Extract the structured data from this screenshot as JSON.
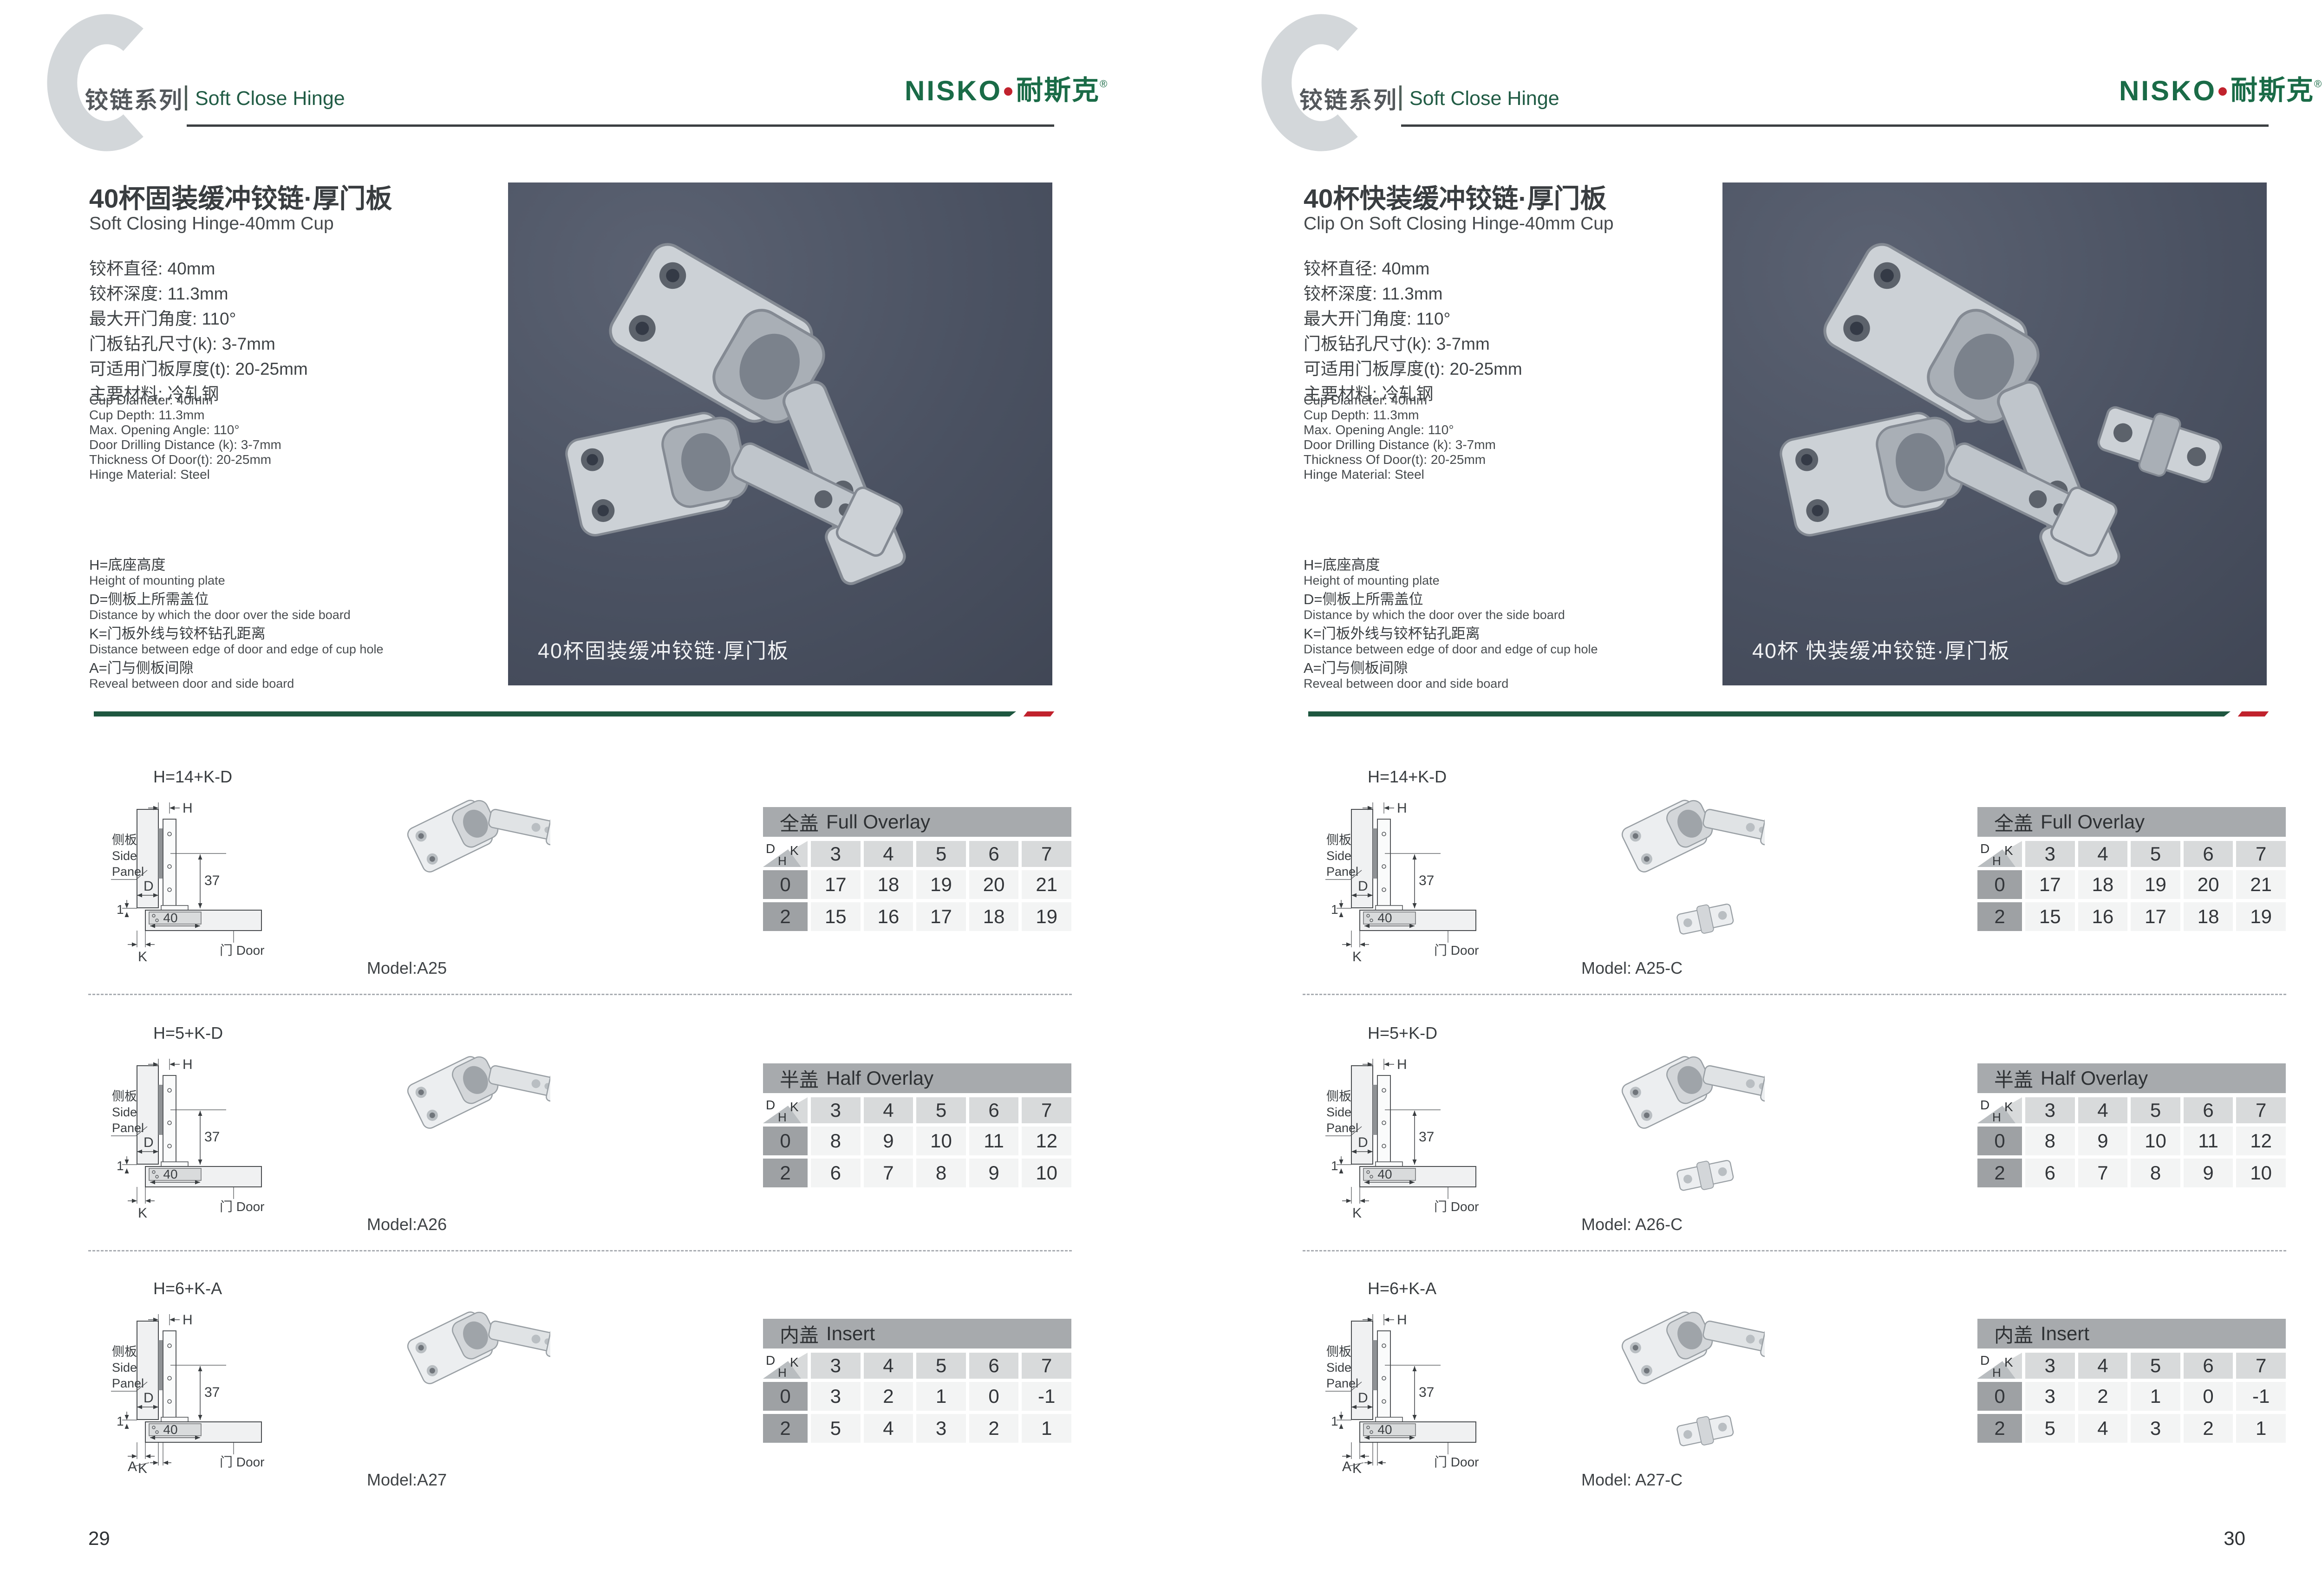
{
  "brand": {
    "latin": "NISKO",
    "cn": "耐斯克",
    "reg": "®"
  },
  "header": {
    "series_cn": "铰链系列",
    "series_en": "Soft Close Hinge",
    "watermark_letter": "C"
  },
  "specs_cn": [
    "铰杯直径: 40mm",
    "铰杯深度: 11.3mm",
    "最大开门角度: 110°",
    "门板钻孔尺寸(k): 3-7mm",
    "可适用门板厚度(t): 20-25mm",
    "主要材料: 冷轧钢"
  ],
  "specs_en": [
    "Cup Diameter: 40mm",
    "Cup Depth: 11.3mm",
    "Max. Opening Angle: 110°",
    "Door Drilling Distance (k): 3-7mm",
    "Thickness Of Door(t): 20-25mm",
    "Hinge Material: Steel"
  ],
  "legend": [
    {
      "cn": "H=底座高度",
      "en": "Height of mounting plate"
    },
    {
      "cn": "D=侧板上所需盖位",
      "en": "Distance by which the door over the side board"
    },
    {
      "cn": "K=门板外线与铰杯钻孔距离",
      "en": "Distance between edge of door and edge of cup hole"
    },
    {
      "cn": "A=门与侧板间隙",
      "en": "Reveal between door and side board"
    }
  ],
  "diagram_labels": {
    "h": "H",
    "d": "D",
    "k": "K",
    "a": "A",
    "one": "1",
    "forty": "40",
    "thirtyseven": "37",
    "side_cn": "侧板",
    "side_en1": "Side",
    "side_en2": "Panel",
    "door": "门 Door"
  },
  "tables": [
    {
      "title_cn": "全盖",
      "title_en": "Full Overlay",
      "corner": {
        "d": "D",
        "k": "K",
        "h": "H"
      },
      "k_values": [
        "3",
        "4",
        "5",
        "6",
        "7"
      ],
      "rows": [
        {
          "h": "0",
          "values": [
            "17",
            "18",
            "19",
            "20",
            "21"
          ]
        },
        {
          "h": "2",
          "values": [
            "15",
            "16",
            "17",
            "18",
            "19"
          ]
        }
      ]
    },
    {
      "title_cn": "半盖",
      "title_en": "Half Overlay",
      "corner": {
        "d": "D",
        "k": "K",
        "h": "H"
      },
      "k_values": [
        "3",
        "4",
        "5",
        "6",
        "7"
      ],
      "rows": [
        {
          "h": "0",
          "values": [
            "8",
            "9",
            "10",
            "11",
            "12"
          ]
        },
        {
          "h": "2",
          "values": [
            "6",
            "7",
            "8",
            "9",
            "10"
          ]
        }
      ]
    },
    {
      "title_cn": "内盖",
      "title_en": "Insert",
      "corner": {
        "d": "D",
        "k": "K",
        "h": "H"
      },
      "k_values": [
        "3",
        "4",
        "5",
        "6",
        "7"
      ],
      "rows": [
        {
          "h": "0",
          "values": [
            "3",
            "2",
            "1",
            "0",
            "-1"
          ]
        },
        {
          "h": "2",
          "values": [
            "5",
            "4",
            "3",
            "2",
            "1"
          ]
        }
      ]
    }
  ],
  "pages": [
    {
      "title_cn": "40杯固装缓冲铰链·厚门板",
      "title_en": "Soft Closing Hinge-40mm Cup",
      "photo_caption": "40杯固装缓冲铰链·厚门板",
      "hinge_type": "fixed",
      "formulas": [
        "H=14+K-D",
        "H=5+K-D",
        "H=6+K-A"
      ],
      "models": [
        "Model:A25",
        "Model:A26",
        "Model:A27"
      ],
      "page_number": "29"
    },
    {
      "title_cn": "40杯快装缓冲铰链·厚门板",
      "title_en": "Clip On Soft Closing Hinge-40mm Cup",
      "photo_caption": "40杯 快装缓冲铰链·厚门板",
      "hinge_type": "clip",
      "formulas": [
        "H=14+K-D",
        "H=5+K-D",
        "H=6+K-A"
      ],
      "models": [
        "Model: A25-C",
        "Model: A26-C",
        "Model: A27-C"
      ],
      "page_number": "30"
    }
  ],
  "colors": {
    "brand_green": "#1a6b47",
    "series_green": "#215c45",
    "accent_red": "#c1222d",
    "sep_green": "#1e5740",
    "rule": "#3b3f42",
    "watermark": "#d3d7da",
    "photo_bg1": "#4a5161",
    "photo_bg2": "#3c4250",
    "tbl_title_bg": "#a7aaad",
    "tbl_k_bg": "#d8dadb",
    "tbl_label_bg": "#9ea1a4",
    "tbl_cell_bg": "#f3f4f4",
    "corner_tri1": "#d8dadb",
    "corner_tri2": "#b9bdc0",
    "dash": "#a9adb2",
    "text_dark": "#3a3e41"
  }
}
